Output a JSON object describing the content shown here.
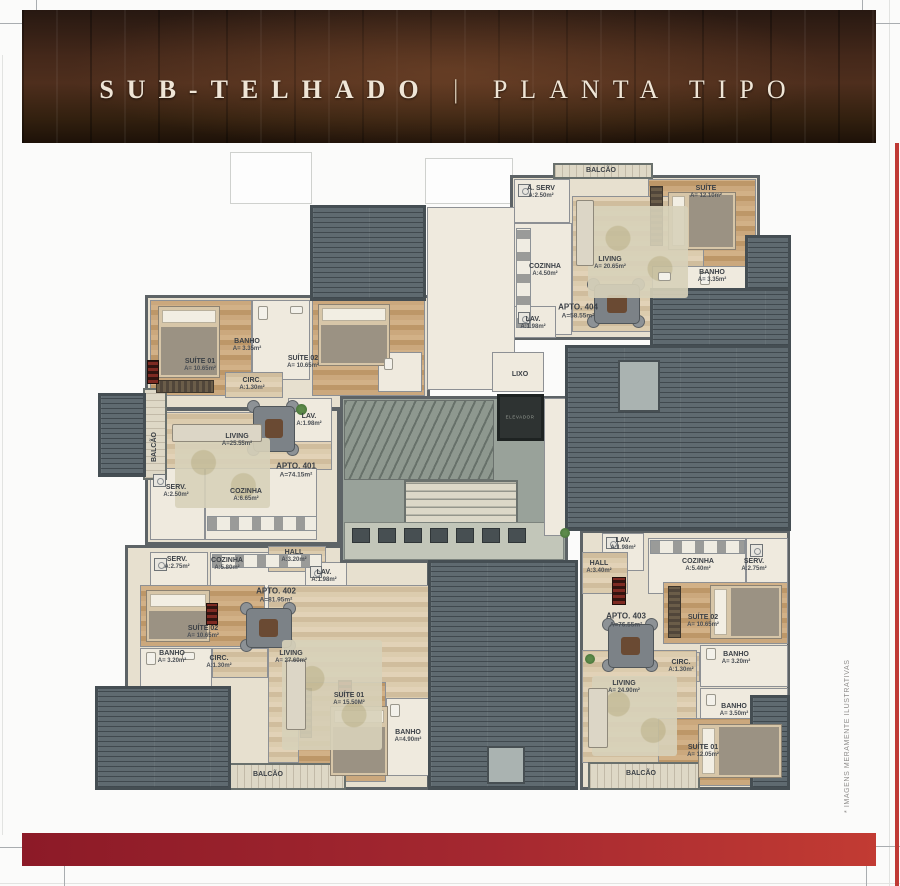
{
  "page": {
    "title_left": "SUB-TELHADO",
    "title_sep": "|",
    "title_right": "PLANTA TIPO",
    "side_note": "* IMAGENS MERAMENTE ILUSTRATIVAS",
    "colors": {
      "banner_wood": "#44281a",
      "bar_red_dark": "#8c1a27",
      "bar_red_light": "#c23b33",
      "edge_red": "#bf3a35",
      "roof_gray": "#5f6a70",
      "wall_gray": "#5d6366",
      "wood_floor": "#c9a478",
      "label_ink": "#3b4046"
    }
  },
  "core": {
    "lixo": "LIXO",
    "elevador": "ELEVADOR"
  },
  "apartments": {
    "apt401": {
      "label": "APTO. 401",
      "area": "A=74.15m²",
      "rooms": {
        "suite01": {
          "name": "SUÍTE 01",
          "area": "A= 10.65m²"
        },
        "banho": {
          "name": "BANHO",
          "area": "A= 3.35m²"
        },
        "suite02": {
          "name": "SUÍTE 02",
          "area": "A= 10.65m²"
        },
        "circ": {
          "name": "CIRC.",
          "area": "A:1.30m²"
        },
        "living": {
          "name": "LIVING",
          "area": "A=25.55m²"
        },
        "lav": {
          "name": "LAV.",
          "area": "A:1.98m²"
        },
        "serv": {
          "name": "SERV.",
          "area": "A:2.50m²"
        },
        "cozinha": {
          "name": "COZINHA",
          "area": "A:6.65m²"
        },
        "balcao": {
          "name": "BALCÃO"
        }
      }
    },
    "apt402": {
      "label": "APTO. 402",
      "area": "A=81.95m²",
      "rooms": {
        "serv": {
          "name": "SERV.",
          "area": "A:2.75m²"
        },
        "cozinha": {
          "name": "COZINHA",
          "area": "A:5.80m²"
        },
        "hall": {
          "name": "HALL",
          "area": "A:3.20m²"
        },
        "lav": {
          "name": "LAV.",
          "area": "A:1.98m²"
        },
        "suite02": {
          "name": "SUÍTE 02",
          "area": "A= 10.65m²"
        },
        "banho": {
          "name": "BANHO",
          "area": "A= 3.20m²"
        },
        "circ": {
          "name": "CIRC.",
          "area": "A:1.30m²"
        },
        "living": {
          "name": "LIVING",
          "area": "A= 27.60m²"
        },
        "suite01": {
          "name": "SUÍTE 01",
          "area": "A= 15.50M²"
        },
        "banho2": {
          "name": "BANHO",
          "area": "A=4.90m²"
        },
        "balcao": {
          "name": "BALCÃO"
        }
      }
    },
    "apt403": {
      "label": "APTO. 403",
      "area": "A=76.55m²",
      "rooms": {
        "lav": {
          "name": "LAV.",
          "area": "A:1.98m²"
        },
        "hall": {
          "name": "HALL",
          "area": "A:3.40m²"
        },
        "cozinha": {
          "name": "COZINHA",
          "area": "A:5.40m²"
        },
        "serv": {
          "name": "SERV.",
          "area": "A:2.75m²"
        },
        "suite02": {
          "name": "SUÍTE 02",
          "area": "A= 10.65m²"
        },
        "banho": {
          "name": "BANHO",
          "area": "A= 3.20m²"
        },
        "circ": {
          "name": "CIRC.",
          "area": "A:1.30m²"
        },
        "living": {
          "name": "LIVING",
          "area": "A= 24.90m²"
        },
        "banho2": {
          "name": "BANHO",
          "area": "A= 3.50m²"
        },
        "suite01": {
          "name": "SUÍTE 01",
          "area": "A= 12.05m²"
        },
        "balcao": {
          "name": "BALCÃO"
        }
      }
    },
    "apt404": {
      "label": "APTO. 404",
      "area": "A=58.55m²",
      "rooms": {
        "balcao": {
          "name": "BALCÃO"
        },
        "aserv": {
          "name": "A. SERV",
          "area": "A:2.50m²"
        },
        "suite": {
          "name": "SUÍTE",
          "area": "A= 12.10m²"
        },
        "cozinha": {
          "name": "COZINHA",
          "area": "A:4.50m²"
        },
        "living": {
          "name": "LIVING",
          "area": "A= 20.65m²"
        },
        "banho": {
          "name": "BANHO",
          "area": "A= 3.35m²"
        },
        "lav": {
          "name": "LAV.",
          "area": "A:1.98m²"
        }
      }
    }
  }
}
